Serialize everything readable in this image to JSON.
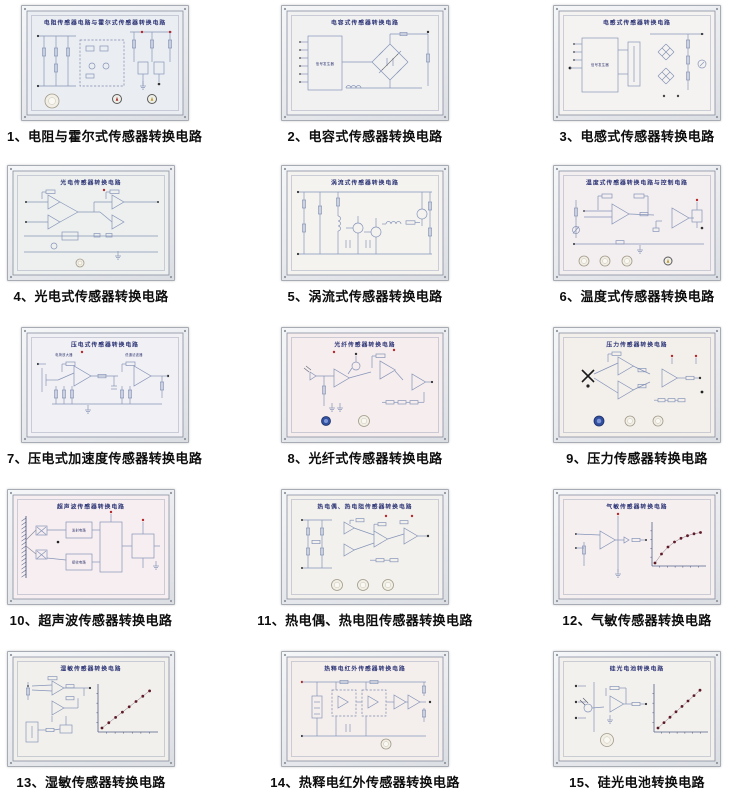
{
  "page": {
    "background": "#ffffff"
  },
  "colors": {
    "schematic_line": "#8694b8",
    "board_title_text": "#2b3375",
    "caption_text": "#0d0d0d",
    "test_point_red": "#b5282d",
    "graph_dot_maroon": "#5e1a26",
    "knob_blue": "#31509f",
    "knob_white": "#f2efe6"
  },
  "panels": [
    {
      "caption": "1、电阻与霍尔式传感器转换电路",
      "board_title": "电阻传感器电路与霍尔式传感器转换电路",
      "variant": "dense",
      "bg": "#eaedf1",
      "labels": [],
      "controls": [
        {
          "kind": "white",
          "x": 30,
          "y": 95,
          "r": 7
        },
        {
          "kind": "dialR",
          "x": 95,
          "y": 93,
          "r": 4.5
        },
        {
          "kind": "dialY",
          "x": 130,
          "y": 93,
          "r": 4.5
        }
      ]
    },
    {
      "caption": "2、电容式传感器转换电路",
      "board_title": "电容式传感器转换电路",
      "variant": "bridge",
      "bg": "#f1f1f2",
      "labels": [
        {
          "x": 43,
          "y": 59,
          "t": "信号发生器",
          "s": 3.4
        }
      ],
      "controls": []
    },
    {
      "caption": "3、电感式传感器转换电路",
      "board_title": "电感式传感器转换电路",
      "variant": "inductive",
      "bg": "#f5f3f1",
      "labels": [
        {
          "x": 46,
          "y": 60,
          "t": "信号发生器",
          "s": 3.3
        }
      ],
      "controls": []
    },
    {
      "caption": "4、光电式传感器转换电路",
      "board_title": "光电传感器转换电路",
      "variant": "opamps4",
      "bg": "#edf0ef",
      "labels": [],
      "controls": [
        {
          "kind": "white",
          "x": 72,
          "y": 97,
          "r": 4
        }
      ]
    },
    {
      "caption": "5、涡流式传感器转换电路",
      "board_title": "涡流式传感器转换电路",
      "variant": "discrete",
      "bg": "#f4f3f0",
      "labels": [],
      "controls": []
    },
    {
      "caption": "6、温度式传感器转换电路",
      "board_title": "温度式传感器转换电路与控制电路",
      "variant": "temp",
      "bg": "#f3eef0",
      "labels": [],
      "controls": [
        {
          "kind": "white",
          "x": 30,
          "y": 95,
          "r": 5
        },
        {
          "kind": "white",
          "x": 51,
          "y": 95,
          "r": 5
        },
        {
          "kind": "white",
          "x": 73,
          "y": 95,
          "r": 5
        },
        {
          "kind": "dialY",
          "x": 114,
          "y": 95,
          "r": 4
        }
      ]
    },
    {
      "caption": "7、压电式加速度传感器转换电路",
      "board_title": "压电式传感器转换电路",
      "variant": "piezo",
      "bg": "#f1f0f4",
      "labels": [
        {
          "x": 42,
          "y": 28,
          "t": "电荷放大器",
          "s": 3.2
        },
        {
          "x": 112,
          "y": 28,
          "t": "低通滤波器",
          "s": 3.2
        }
      ],
      "controls": []
    },
    {
      "caption": "8、光纤式传感器转换电路",
      "board_title": "光纤传感器转换电路",
      "variant": "fiber",
      "bg": "#f6edee",
      "labels": [],
      "controls": [
        {
          "kind": "blue",
          "x": 44,
          "y": 93,
          "r": 4.5
        },
        {
          "kind": "white",
          "x": 82,
          "y": 93,
          "r": 5.5
        }
      ]
    },
    {
      "caption": "9、压力传感器转换电路",
      "board_title": "压力传感器转换电路",
      "variant": "pressure",
      "bg": "#f3f0ec",
      "labels": [],
      "controls": [
        {
          "kind": "blue",
          "x": 45,
          "y": 93,
          "r": 5
        },
        {
          "kind": "white",
          "x": 76,
          "y": 93,
          "r": 5
        },
        {
          "kind": "white",
          "x": 104,
          "y": 93,
          "r": 5
        }
      ]
    },
    {
      "caption": "10、超声波传感器转换电路",
      "board_title": "超声波传感器转换电路",
      "variant": "ultra",
      "bg": "#f6eef0",
      "labels": [
        {
          "x": 71,
          "y": 41.5,
          "t": "发射电路",
          "s": 3.2
        },
        {
          "x": 71,
          "y": 73.5,
          "t": "接收电路",
          "s": 3.2
        }
      ],
      "controls": []
    },
    {
      "caption": "11、热电偶、热电阻传感器转换电路",
      "board_title": "热电偶、热电阻传感器转换电路",
      "variant": "thermo",
      "bg": "#f2f1ed",
      "labels": [],
      "controls": [
        {
          "kind": "white",
          "x": 55,
          "y": 95,
          "r": 5.5
        },
        {
          "kind": "white",
          "x": 81,
          "y": 95,
          "r": 5.5
        },
        {
          "kind": "white",
          "x": 106,
          "y": 95,
          "r": 5.5
        }
      ]
    },
    {
      "caption": "12、气敏传感器转换电路",
      "board_title": "气敏传感器转换电路",
      "variant": "gas",
      "bg": "#f5eff0",
      "labels": [],
      "controls": []
    },
    {
      "caption": "13、湿敏传感器转换电路",
      "board_title": "湿敏传感器转换电路",
      "variant": "humidity",
      "bg": "#f1f0ec",
      "labels": [],
      "controls": []
    },
    {
      "caption": "14、热释电红外传感器转换电路",
      "board_title": "热释电红外传感器转换电路",
      "variant": "pir",
      "bg": "#f4efed",
      "labels": [],
      "controls": [
        {
          "kind": "white",
          "x": 104,
          "y": 92,
          "r": 5
        }
      ]
    },
    {
      "caption": "15、硅光电池转换电路",
      "board_title": "硅光电池转换电路",
      "variant": "photocell",
      "bg": "#f3f1ee",
      "labels": [],
      "controls": [
        {
          "kind": "white",
          "x": 53,
          "y": 88,
          "r": 6.5
        }
      ]
    }
  ]
}
